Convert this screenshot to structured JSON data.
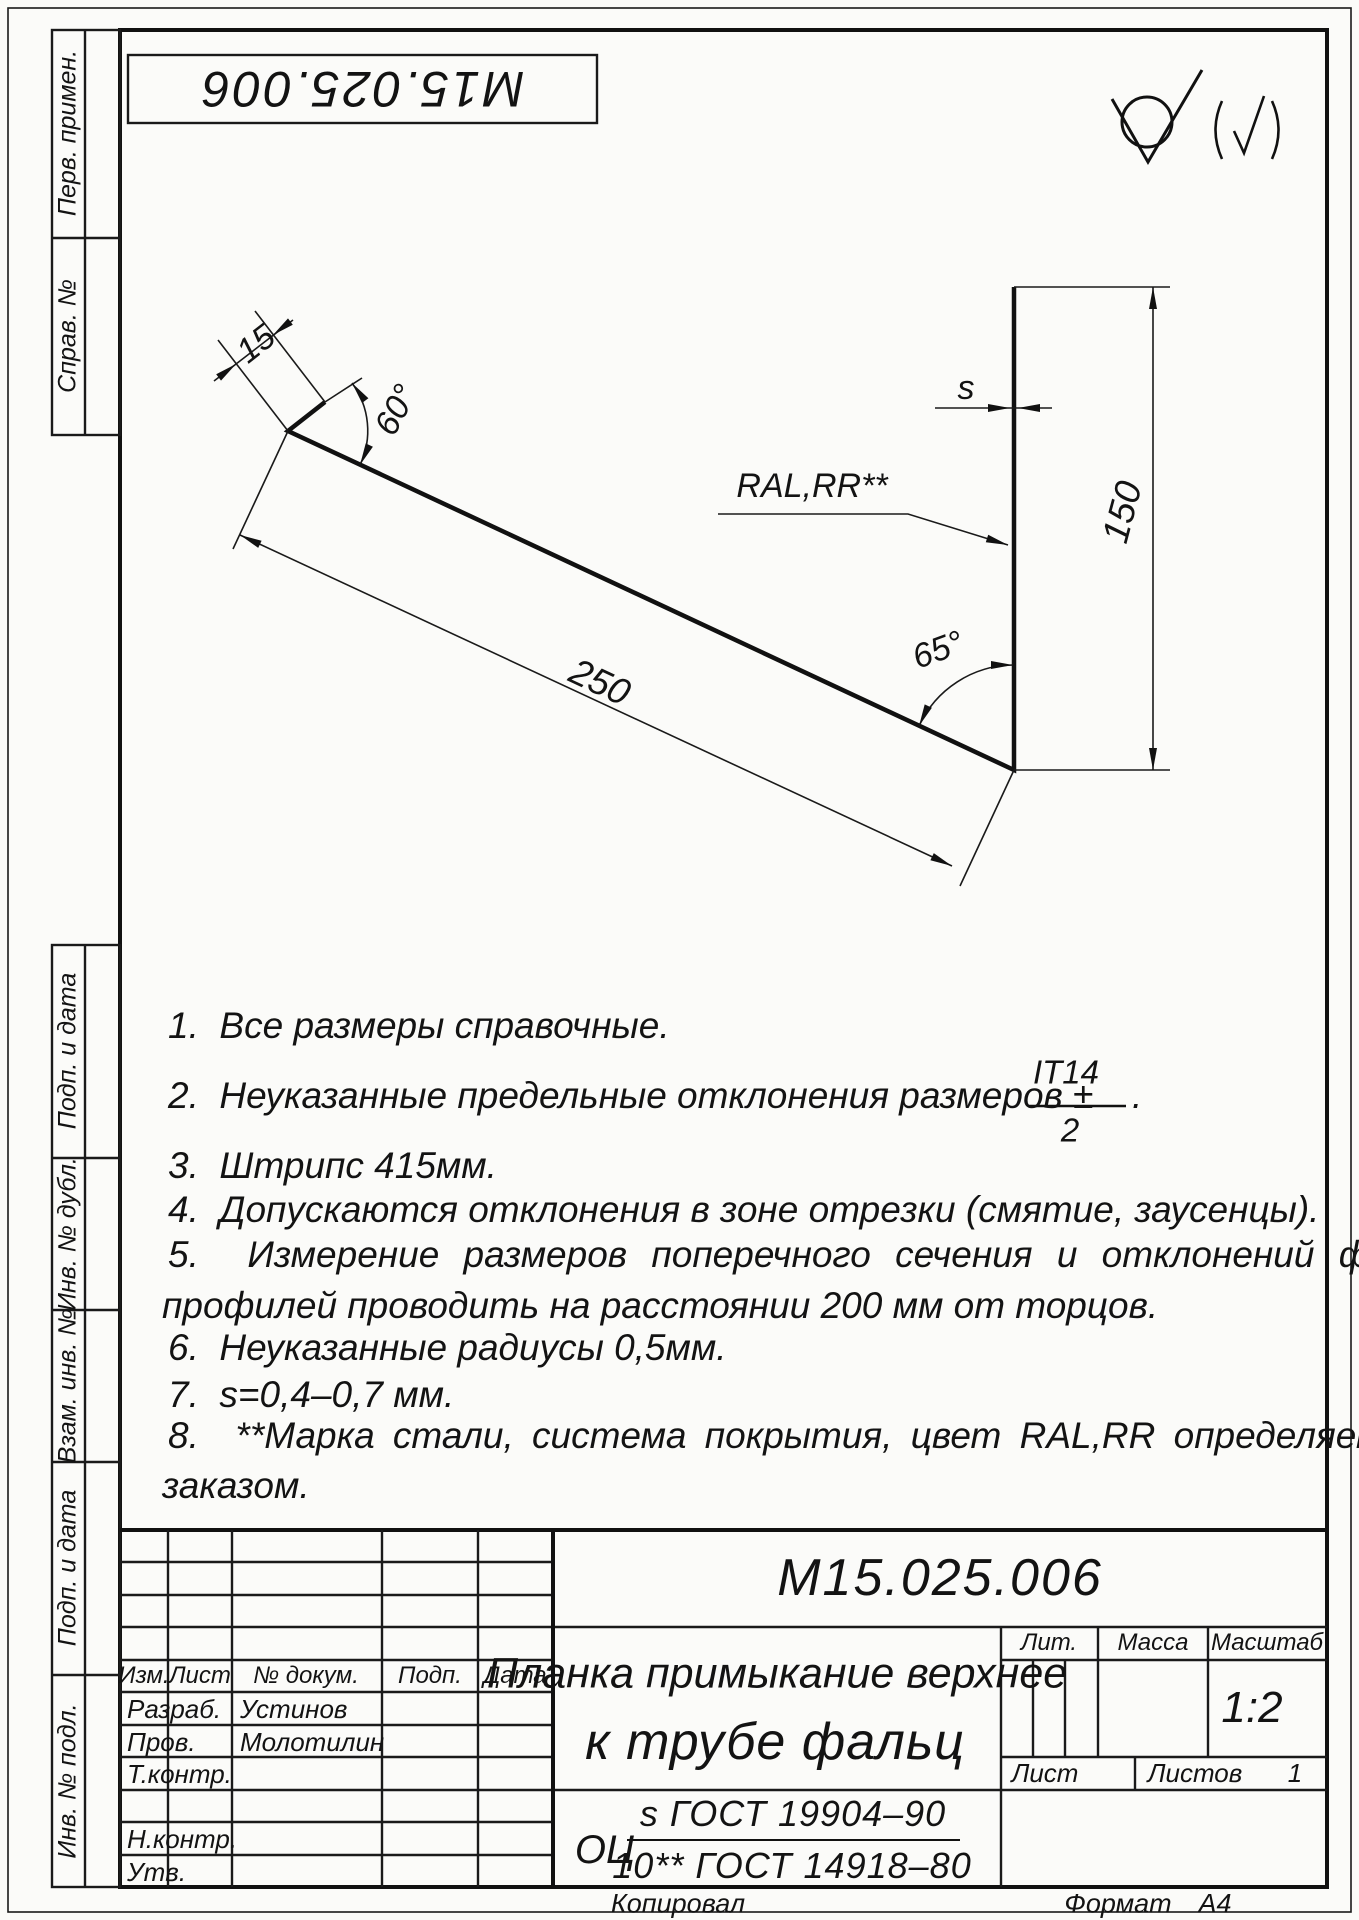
{
  "page": {
    "stamp_top": "М15.025.006",
    "surface_note_paren": "(√)"
  },
  "margins": {
    "perv": "Перв. примен.",
    "sprav": "Справ. №",
    "podp1": "Подп. и дата",
    "dubl": "Инв. № дубл.",
    "vzam": "Взам. инв. №",
    "podp2": "Подп. и дата",
    "podl": "Инв. № подл."
  },
  "drawing": {
    "dim_flange": "15",
    "dim_angle_top": "60°",
    "dim_length": "250",
    "dim_angle_right": "65°",
    "dim_height": "150",
    "dim_thickness": "s",
    "coating_label": "RAL,RR**"
  },
  "notes": {
    "n1": "1.  Все размеры справочные.",
    "n2_pre": "2.  Неуказанные предельные отклонения размеров ±",
    "n2_num": "IT14",
    "n2_den": "2",
    "n2_post": ".",
    "n3": "3.  Штрипс 415мм.",
    "n4": "4.  Допускаются отклонения в зоне отрезки (смятие, заусенцы).",
    "n5a": "5.  Измерение размеров поперечного сечения и отклонений формы",
    "n5b": "профилей проводить на расстоянии 200 мм от торцов.",
    "n6": "6.  Неуказанные радиусы 0,5мм.",
    "n7": "7.  s=0,4–0,7 мм.",
    "n8a": "8.  **Марка стали, система покрытия, цвет RAL,RR определяется",
    "n8b": "заказом."
  },
  "title_block": {
    "designation": "М15.025.006",
    "name_line1": "Планка примыкание верхнее",
    "name_line2": "к трубе фальц",
    "material_prefix": "ОЦ",
    "material_num": "s ГОСТ 19904–90",
    "material_den": "10** ГОСТ 14918–80",
    "col_izm": "Изм.",
    "col_list": "Лист",
    "col_doc": "№ докум.",
    "col_podp": "Подп.",
    "col_data": "Дата",
    "row_razrab": "Разраб.",
    "row_prov": "Пров.",
    "row_tkontr": "Т.контр.",
    "row_nkontr": "Н.контр.",
    "row_utv": "Утв.",
    "dev_name": "Устинов",
    "prov_name": "Молотилин",
    "lit": "Лит.",
    "massa": "Масса",
    "masshtab": "Масштаб",
    "scale": "1:2",
    "list": "Лист",
    "listov": "Листов",
    "listov_val": "1",
    "kopiroval": "Копировал",
    "format": "Формат",
    "format_val": "А4"
  }
}
